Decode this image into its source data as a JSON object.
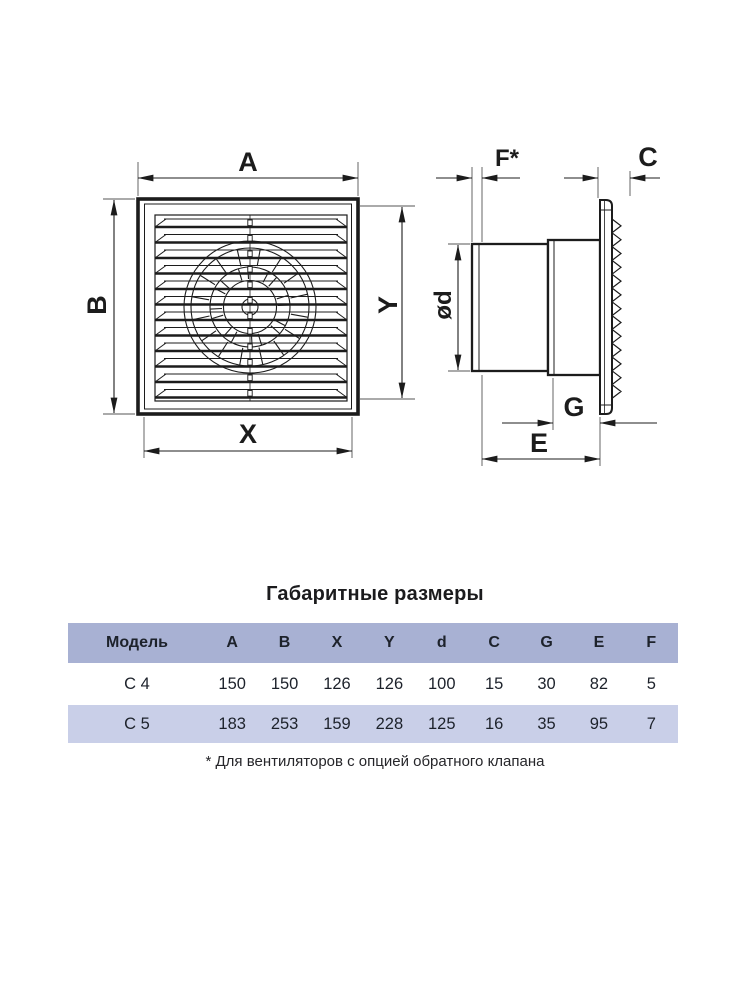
{
  "drawing": {
    "front_view_labels": {
      "top": "A",
      "left": "B",
      "bottom": "X",
      "right": "Y"
    },
    "side_view_labels": {
      "valve_protrusion": "F*",
      "grille_depth": "C",
      "duct_diameter": "ød",
      "collar_depth": "G",
      "body_depth": "E"
    }
  },
  "table": {
    "title": "Габаритные размеры",
    "columns": [
      "Модель",
      "A",
      "B",
      "X",
      "Y",
      "d",
      "C",
      "G",
      "E",
      "F"
    ],
    "rows": [
      {
        "model": "С 4",
        "values": [
          150,
          150,
          126,
          126,
          100,
          15,
          30,
          82,
          5
        ]
      },
      {
        "model": "С 5",
        "values": [
          183,
          253,
          159,
          228,
          125,
          16,
          35,
          95,
          7
        ]
      }
    ],
    "footnote": "* Для вентиляторов с опцией обратного клапана"
  },
  "colors": {
    "line": "#1c1c1c",
    "extension_line": "#555555",
    "table_header_bg": "#a8b1d3",
    "table_alt_row_bg": "#c9cfe8",
    "background": "#ffffff"
  }
}
